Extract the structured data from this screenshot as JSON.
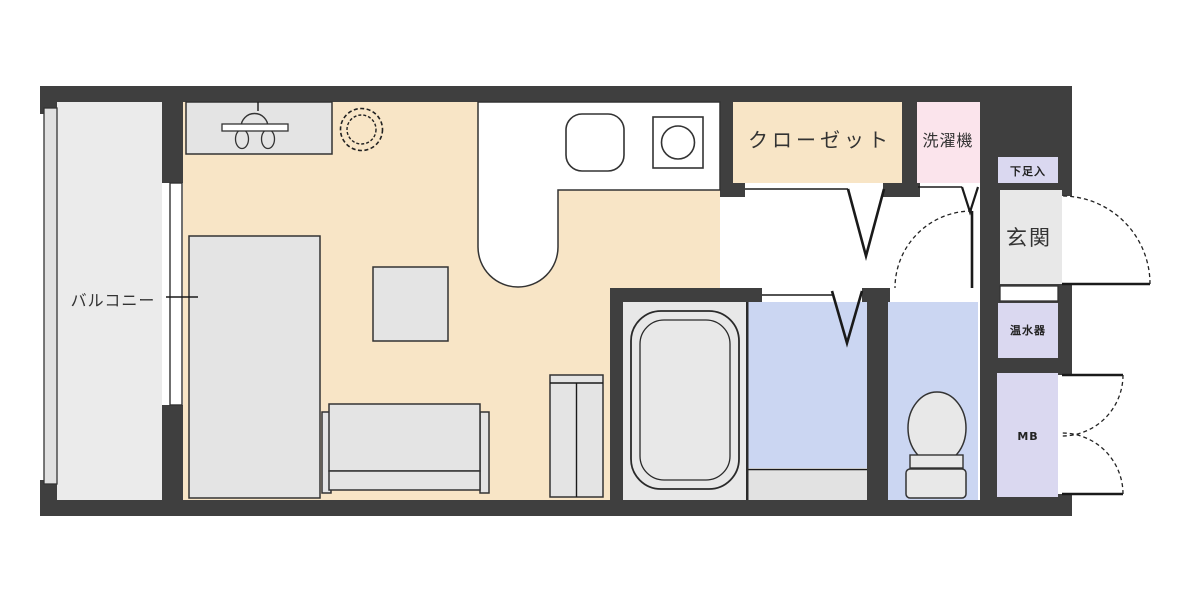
{
  "plan_type": "apartment-floorplan",
  "labels": {
    "balcony": "バルコニー",
    "closet": "クローゼット",
    "washing_machine": "洗濯機",
    "shoe_cabinet": "下足入",
    "entrance": "玄関",
    "water_heater": "温水器",
    "meter_box": "MB"
  },
  "icons": [
    "kitchen-sink-icon",
    "gas-stove-icon",
    "bathtub-icon",
    "toilet-icon",
    "faucet-counter-icon",
    "round-stool-icon",
    "bed-icon",
    "sofa-icon",
    "low-table-icon",
    "cabinet-icon",
    "swing-door-icon",
    "folding-door-icon",
    "double-door-icon",
    "sliding-window-icon",
    "balcony-rail-icon"
  ],
  "colors": {
    "wall": "#3f3f3f",
    "room_floor": "#f8e5c6",
    "balcony_floor": "#ebebeb",
    "wet_area_floor": "#cbd6f2",
    "utility_fill": "#dad8f0",
    "washer_fill": "#fbe4ec",
    "hard_floor": "#e8e8e8",
    "furniture_fill": "#e4e4e4",
    "kitchen_counter": "#ffffff",
    "line": "#1a1a1a"
  }
}
